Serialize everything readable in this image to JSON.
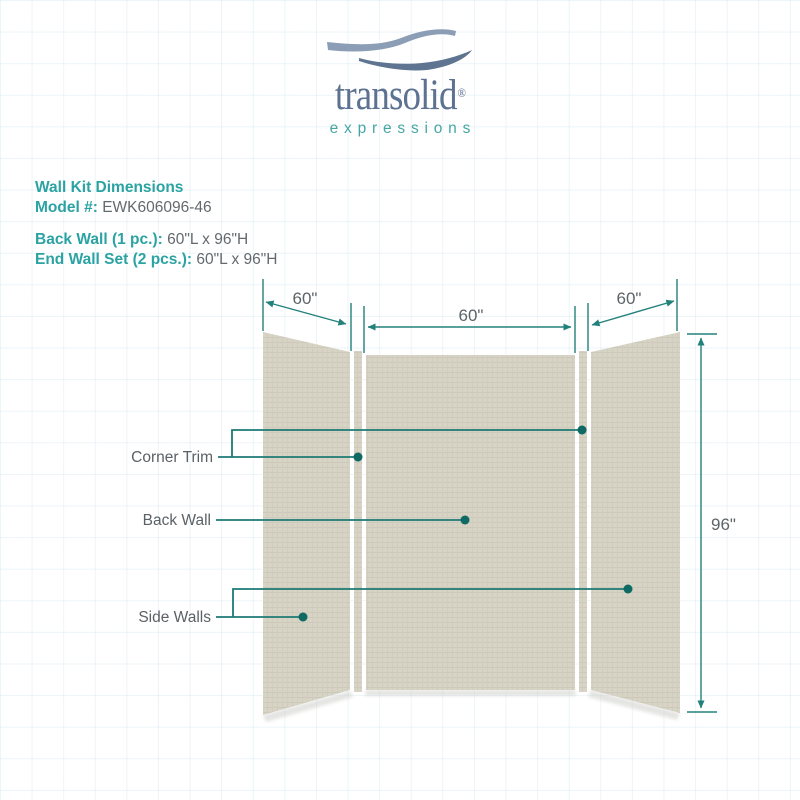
{
  "logo": {
    "brand": "transolid",
    "registered": "®",
    "tagline": "expressions"
  },
  "info": {
    "title": "Wall Kit Dimensions",
    "model_label": "Model #:",
    "model_value": "EWK606096-46",
    "back_wall_label": "Back Wall (1 pc.):",
    "back_wall_value": "60\"L x 96\"H",
    "end_wall_label": "End Wall Set (2 pcs.):",
    "end_wall_value": "60\"L x 96\"H"
  },
  "diagram": {
    "dim_left": "60\"",
    "dim_center": "60\"",
    "dim_right": "60\"",
    "dim_height": "96\"",
    "label_corner_trim": "Corner Trim",
    "label_back_wall": "Back Wall",
    "label_side_walls": "Side Walls"
  },
  "colors": {
    "heading_teal": "#2ba3a3",
    "line_teal": "#23817c",
    "dot_teal": "#0e6a63",
    "text_gray": "#63696e",
    "panel_beige": "#d7d3c5",
    "logo_blue": "#5d7191",
    "wave_light": "#8c9db6",
    "wave_dark": "#5e7490",
    "tagline_teal": "#47a6a4"
  }
}
